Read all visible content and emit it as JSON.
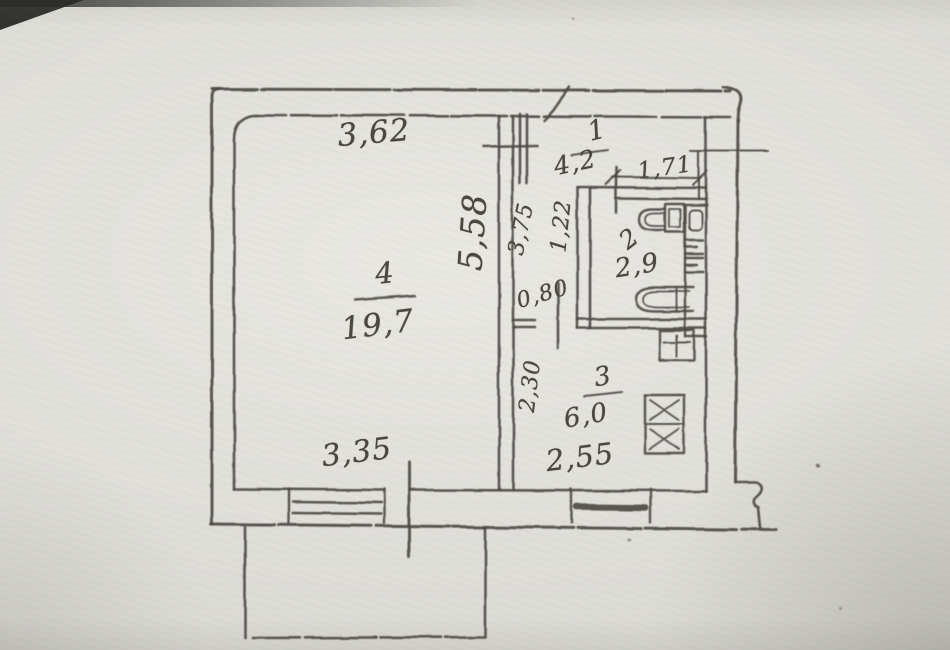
{
  "title": "Scanned hand-drawn apartment floor plan",
  "plan": {
    "rooms": {
      "living": {
        "number": "4",
        "area": "19,7"
      },
      "hall": {
        "number": "1",
        "area": "4,2"
      },
      "bath": {
        "number": "2",
        "area": "2,9"
      },
      "kitchen": {
        "number": "3",
        "area": "6,0"
      }
    },
    "dimensions": {
      "living_width_top": "3,62",
      "living_depth": "5,58",
      "living_width_bottom": "3,35",
      "hall_depth": "3,75",
      "corridor_width": "1,22",
      "hall_door_width": "0,80",
      "bath_width": "1,71",
      "kitchen_depth": "2,30",
      "kitchen_width": "2,55"
    },
    "fixtures": [
      "toilet",
      "bathtub",
      "washbasin",
      "kitchen-sink",
      "stove"
    ],
    "features": [
      "balcony",
      "living-room-window",
      "kitchen-window",
      "balcony-door",
      "entry-door"
    ],
    "colors": {
      "paper": "#deddd8",
      "ink": "#4b4843"
    }
  }
}
